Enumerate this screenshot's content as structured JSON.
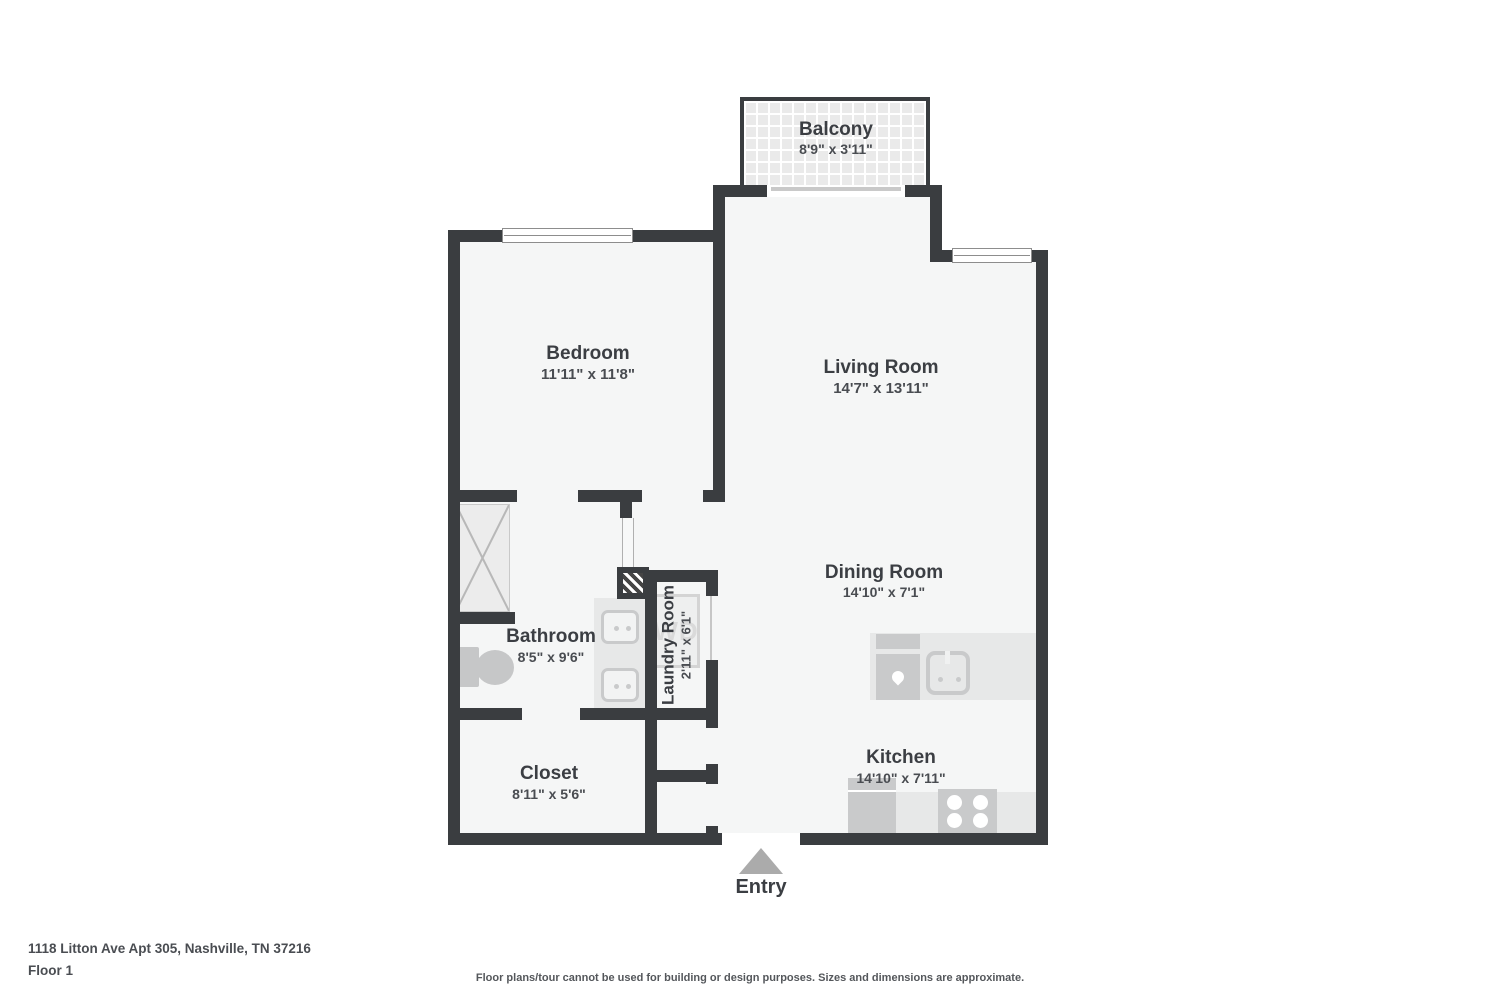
{
  "colors": {
    "wall": "#3a3d40",
    "room_fill": "#f5f6f6",
    "counter": "#e7e8e8",
    "appliance": "#c9cacb",
    "entry_arrow": "#ababab"
  },
  "floorplan": {
    "rooms": [
      {
        "name": "Balcony",
        "dims": "8'9\" x 3'11\""
      },
      {
        "name": "Bedroom",
        "dims": "11'11\" x 11'8\""
      },
      {
        "name": "Living Room",
        "dims": "14'7\" x 13'11\""
      },
      {
        "name": "Dining Room",
        "dims": "14'10\" x 7'1\""
      },
      {
        "name": "Bathroom",
        "dims": "8'5\" x 9'6\""
      },
      {
        "name": "Laundry Room",
        "dims": "2'11\" x 6'1\""
      },
      {
        "name": "Closet",
        "dims": "8'11\" x 5'6\""
      },
      {
        "name": "Kitchen",
        "dims": "14'10\" x 7'11\""
      }
    ],
    "entry_label": "Entry",
    "washer_dryer_label": "WD"
  },
  "footer": {
    "address": "1118 Litton Ave Apt 305, Nashville, TN 37216",
    "floor": "Floor 1",
    "disclaimer": "Floor plans/tour cannot be used for building or design purposes. Sizes and dimensions are approximate."
  }
}
